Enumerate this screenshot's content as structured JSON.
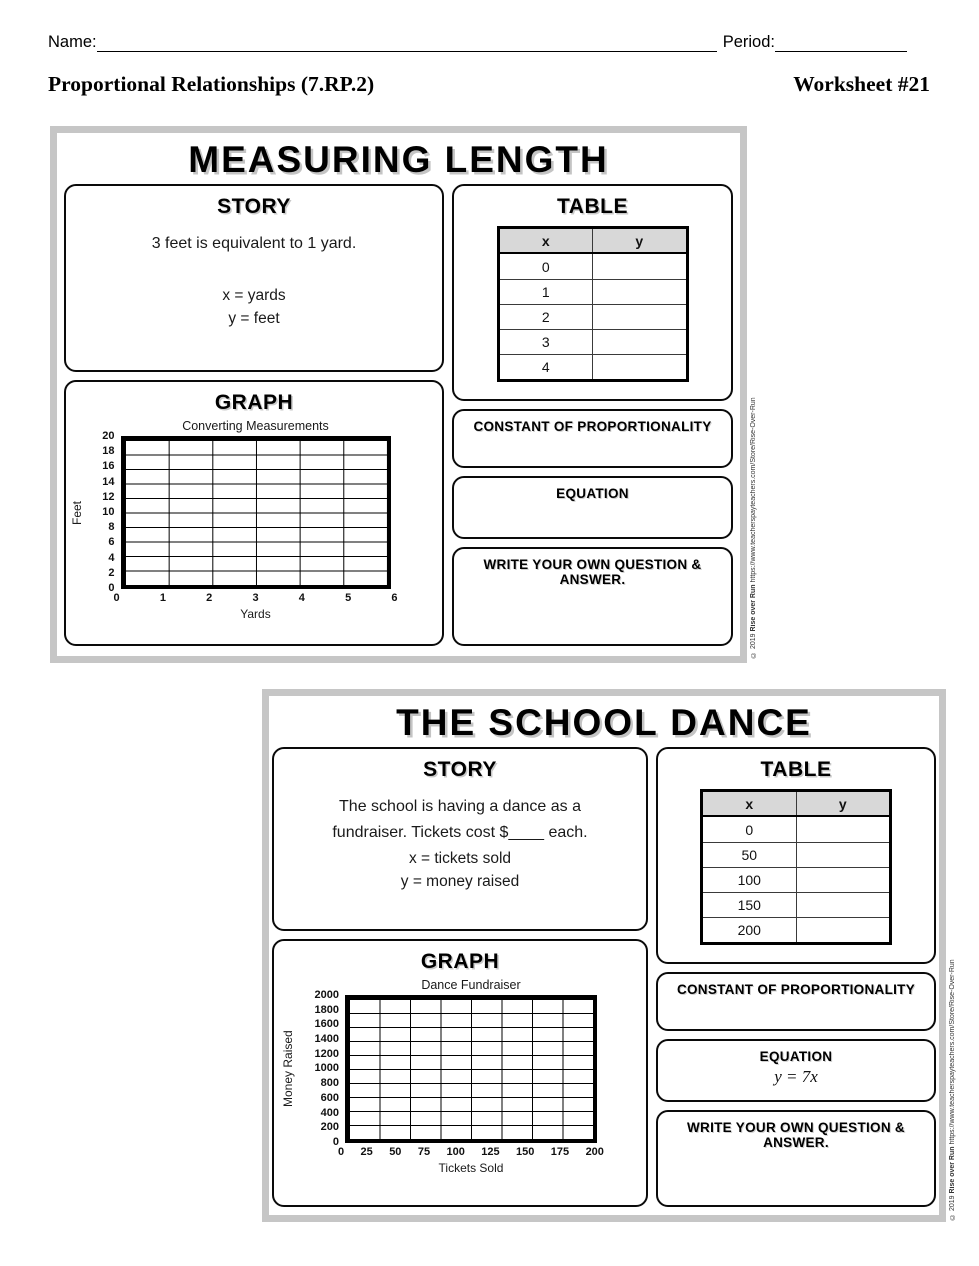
{
  "header": {
    "name_label": "Name:",
    "period_label": "Period:",
    "course_title": "Proportional Relationships (7.RP.2)",
    "worksheet_number": "Worksheet #21"
  },
  "copyright": {
    "prefix": "© 2019 ",
    "author": "Rise over Run",
    "url": " https://www.teacherspayteachers.com/Store/Rise-Over-Run"
  },
  "panel1": {
    "title": "MEASURING LENGTH",
    "story": {
      "heading": "STORY",
      "lines": [
        "3 feet is equivalent to 1 yard."
      ],
      "x_def": "x = yards",
      "y_def": "y = feet"
    },
    "table": {
      "heading": "TABLE",
      "col_x": "x",
      "col_y": "y",
      "x_values": [
        "0",
        "1",
        "2",
        "3",
        "4"
      ]
    },
    "graph": {
      "heading": "GRAPH",
      "title": "Converting Measurements",
      "ylabel": "Feet",
      "xlabel": "Yards",
      "y_ticks": [
        "20",
        "18",
        "16",
        "14",
        "12",
        "10",
        "8",
        "6",
        "4",
        "2",
        "0"
      ],
      "x_ticks": [
        "0",
        "1",
        "2",
        "3",
        "4",
        "5",
        "6"
      ],
      "cols": 6,
      "rows": 10
    },
    "constant": {
      "heading": "CONSTANT OF PROPORTIONALITY",
      "value": ""
    },
    "equation": {
      "heading": "EQUATION",
      "value": ""
    },
    "own_question": {
      "heading": "WRITE YOUR OWN QUESTION & ANSWER.",
      "value": ""
    }
  },
  "panel2": {
    "title": "THE SCHOOL DANCE",
    "story": {
      "heading": "STORY",
      "lines": [
        "The school is having a dance as a",
        "fundraiser.  Tickets cost $____ each."
      ],
      "x_def": "x = tickets sold",
      "y_def": "y = money raised"
    },
    "table": {
      "heading": "TABLE",
      "col_x": "x",
      "col_y": "y",
      "x_values": [
        "0",
        "50",
        "100",
        "150",
        "200"
      ]
    },
    "graph": {
      "heading": "GRAPH",
      "title": "Dance Fundraiser",
      "ylabel": "Money Raised",
      "xlabel": "Tickets Sold",
      "y_ticks": [
        "2000",
        "1800",
        "1600",
        "1400",
        "1200",
        "1000",
        "800",
        "600",
        "400",
        "200",
        "0"
      ],
      "x_ticks": [
        "0",
        "25",
        "50",
        "75",
        "100",
        "125",
        "150",
        "175",
        "200"
      ],
      "cols": 8,
      "rows": 10
    },
    "constant": {
      "heading": "CONSTANT OF PROPORTIONALITY",
      "value": ""
    },
    "equation": {
      "heading": "EQUATION",
      "value": "y = 7x"
    },
    "own_question": {
      "heading": "WRITE YOUR OWN QUESTION & ANSWER.",
      "value": ""
    }
  },
  "chart_data": [
    {
      "type": "line",
      "title": "Converting Measurements",
      "xlabel": "Yards",
      "ylabel": "Feet",
      "xlim": [
        0,
        6
      ],
      "ylim": [
        0,
        20
      ],
      "x_ticks": [
        0,
        1,
        2,
        3,
        4,
        5,
        6
      ],
      "y_ticks": [
        0,
        2,
        4,
        6,
        8,
        10,
        12,
        14,
        16,
        18,
        20
      ],
      "grid": true,
      "series": [],
      "note": "Blank worksheet grid — no data plotted; students fill in."
    },
    {
      "type": "line",
      "title": "Dance Fundraiser",
      "xlabel": "Tickets Sold",
      "ylabel": "Money Raised",
      "xlim": [
        0,
        200
      ],
      "ylim": [
        0,
        2000
      ],
      "x_ticks": [
        0,
        25,
        50,
        75,
        100,
        125,
        150,
        175,
        200
      ],
      "y_ticks": [
        0,
        200,
        400,
        600,
        800,
        1000,
        1200,
        1400,
        1600,
        1800,
        2000
      ],
      "grid": true,
      "series": [],
      "note": "Blank worksheet grid — no data plotted; students fill in."
    }
  ]
}
